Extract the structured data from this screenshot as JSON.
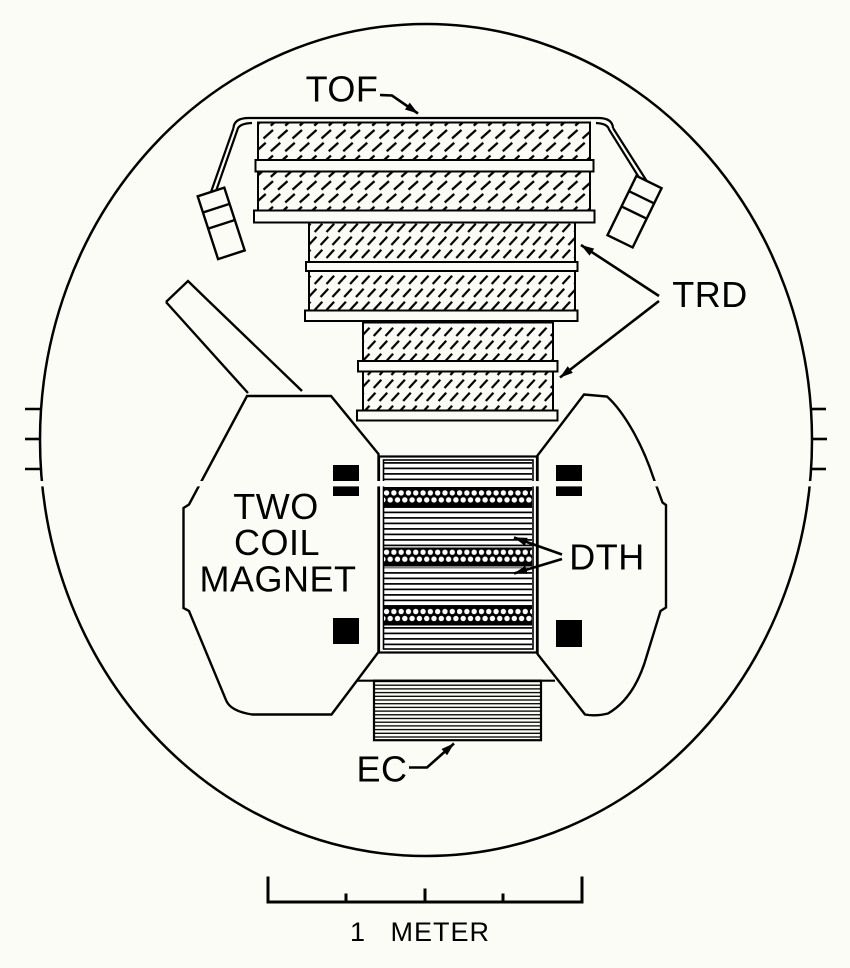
{
  "figure": {
    "type": "detector-cross-section-diagram",
    "background": "#fcfcf6",
    "line_color": "#000000",
    "labels": {
      "tof": "TOF",
      "trd": "TRD",
      "dth": "DTH",
      "ec": "EC",
      "magnet_line1": "TWO",
      "magnet_line2": "COIL",
      "magnet_line3": "MAGNET"
    },
    "scale_bar": {
      "label": "1 METER"
    }
  }
}
